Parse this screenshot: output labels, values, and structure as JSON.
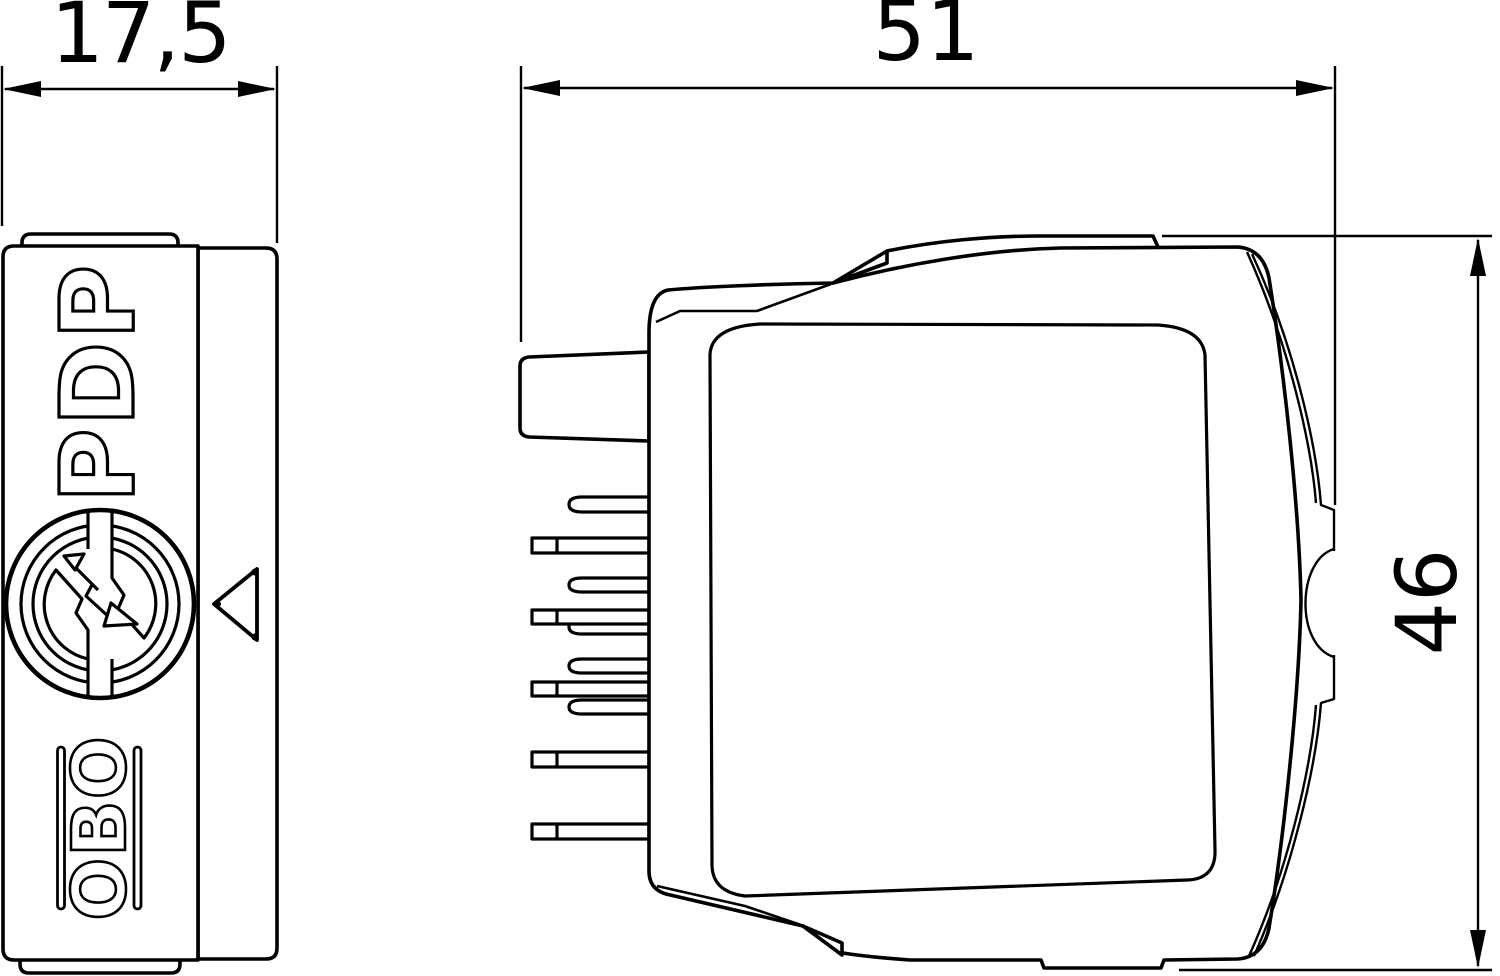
{
  "drawing": {
    "background_color": "#ffffff",
    "line_color": "#000000",
    "dimensions": {
      "front_width": {
        "label": "17,5",
        "orientation": "horizontal"
      },
      "side_width": {
        "label": "51",
        "orientation": "horizontal"
      },
      "side_height": {
        "label": "46",
        "orientation": "vertical"
      }
    },
    "front_view": {
      "product_label": "PDP",
      "brand_label": "OBO",
      "icons": [
        {
          "name": "surge-arrester-logo-icon",
          "description": "circle with concentric rings and lightning flash"
        },
        {
          "name": "lightning-flash-icon"
        },
        {
          "name": "triangle-marker-icon"
        }
      ]
    },
    "side_view": {
      "features": [
        "mounting-lug",
        "connector-pins",
        "clip-tab-top",
        "clip-tab-bottom",
        "grip-dimple",
        "label-recess"
      ]
    }
  }
}
